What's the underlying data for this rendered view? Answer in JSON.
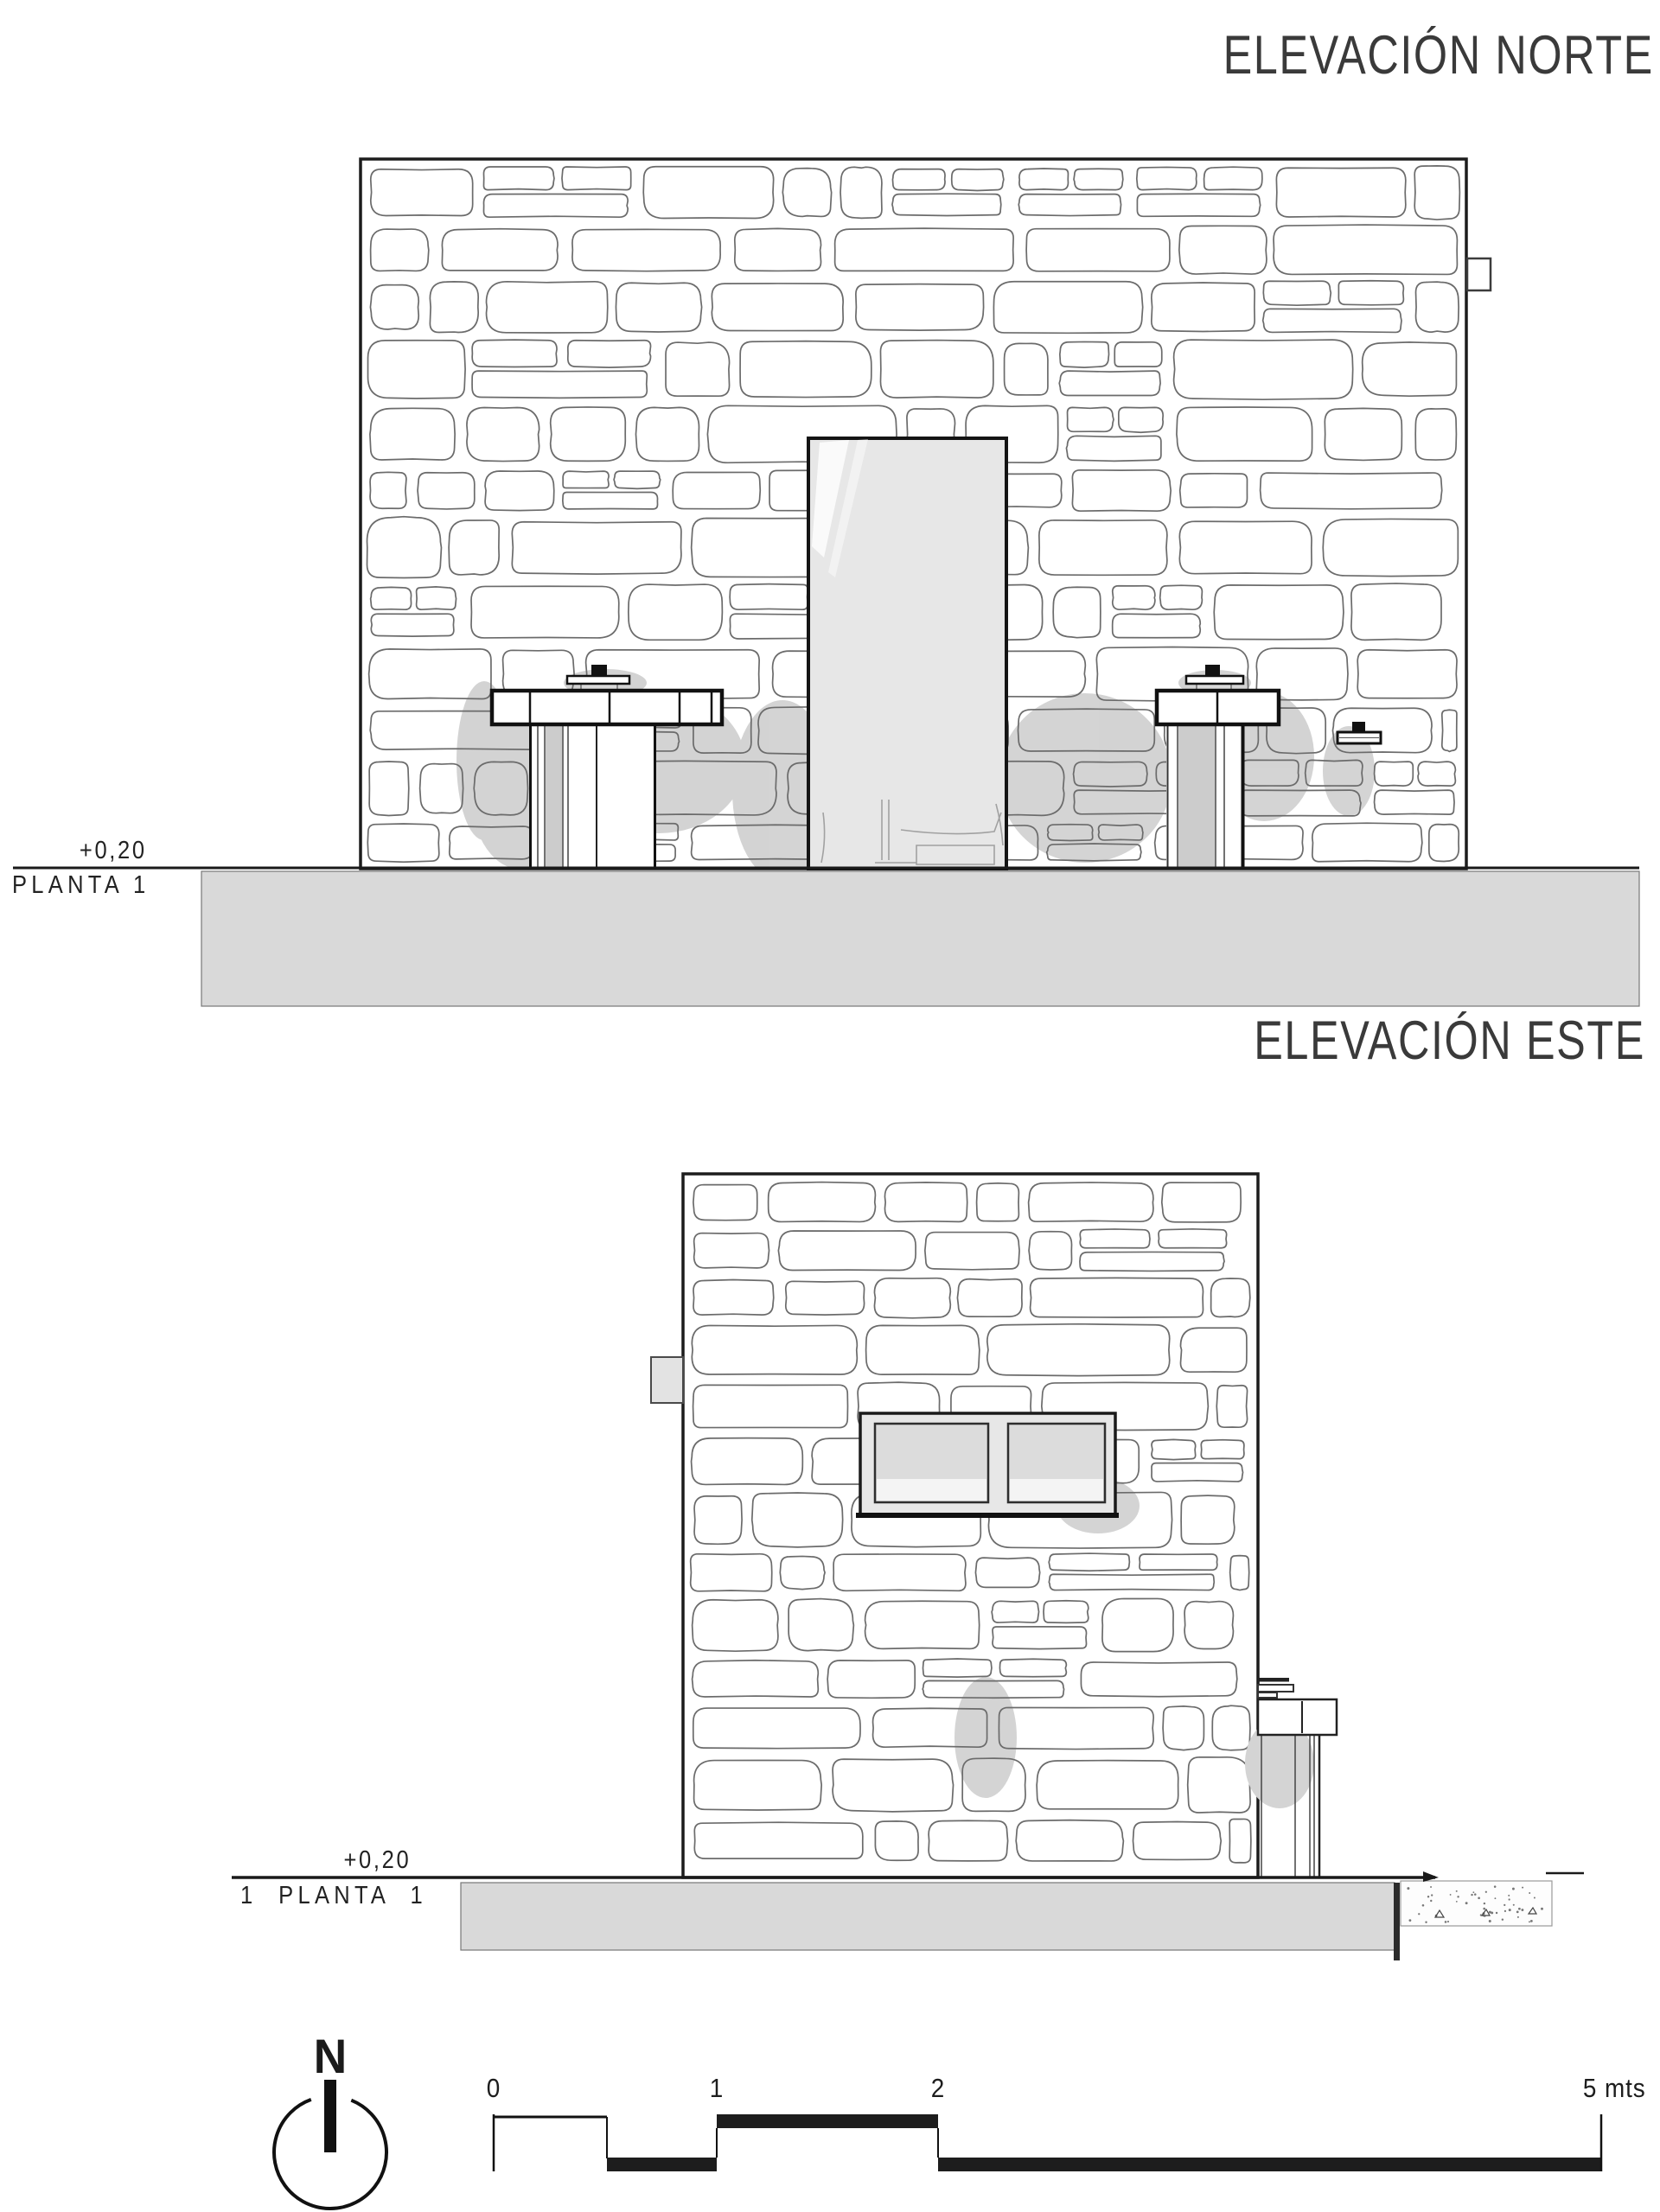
{
  "sheet": {
    "background": "#ffffff",
    "line_color": "#2e2e2e",
    "stone_outline_color": "#6b6b6b",
    "shadow_color": "#c9c9c9",
    "slab_color": "#d9d9d9",
    "door_fill": "#e7e7e7"
  },
  "north_elevation": {
    "title": "ELEVACIÓN NORTE",
    "level_label": "+0,20",
    "floor_label": "PLANTA 1"
  },
  "east_elevation": {
    "title": "ELEVACIÓN ESTE",
    "level_label": "+0,20",
    "floor_label": "1 PLANTA 1"
  },
  "north_arrow": {
    "letter": "N"
  },
  "scale_bar": {
    "tick_labels": [
      "0",
      "1",
      "2"
    ],
    "end_label": "5 mts"
  }
}
